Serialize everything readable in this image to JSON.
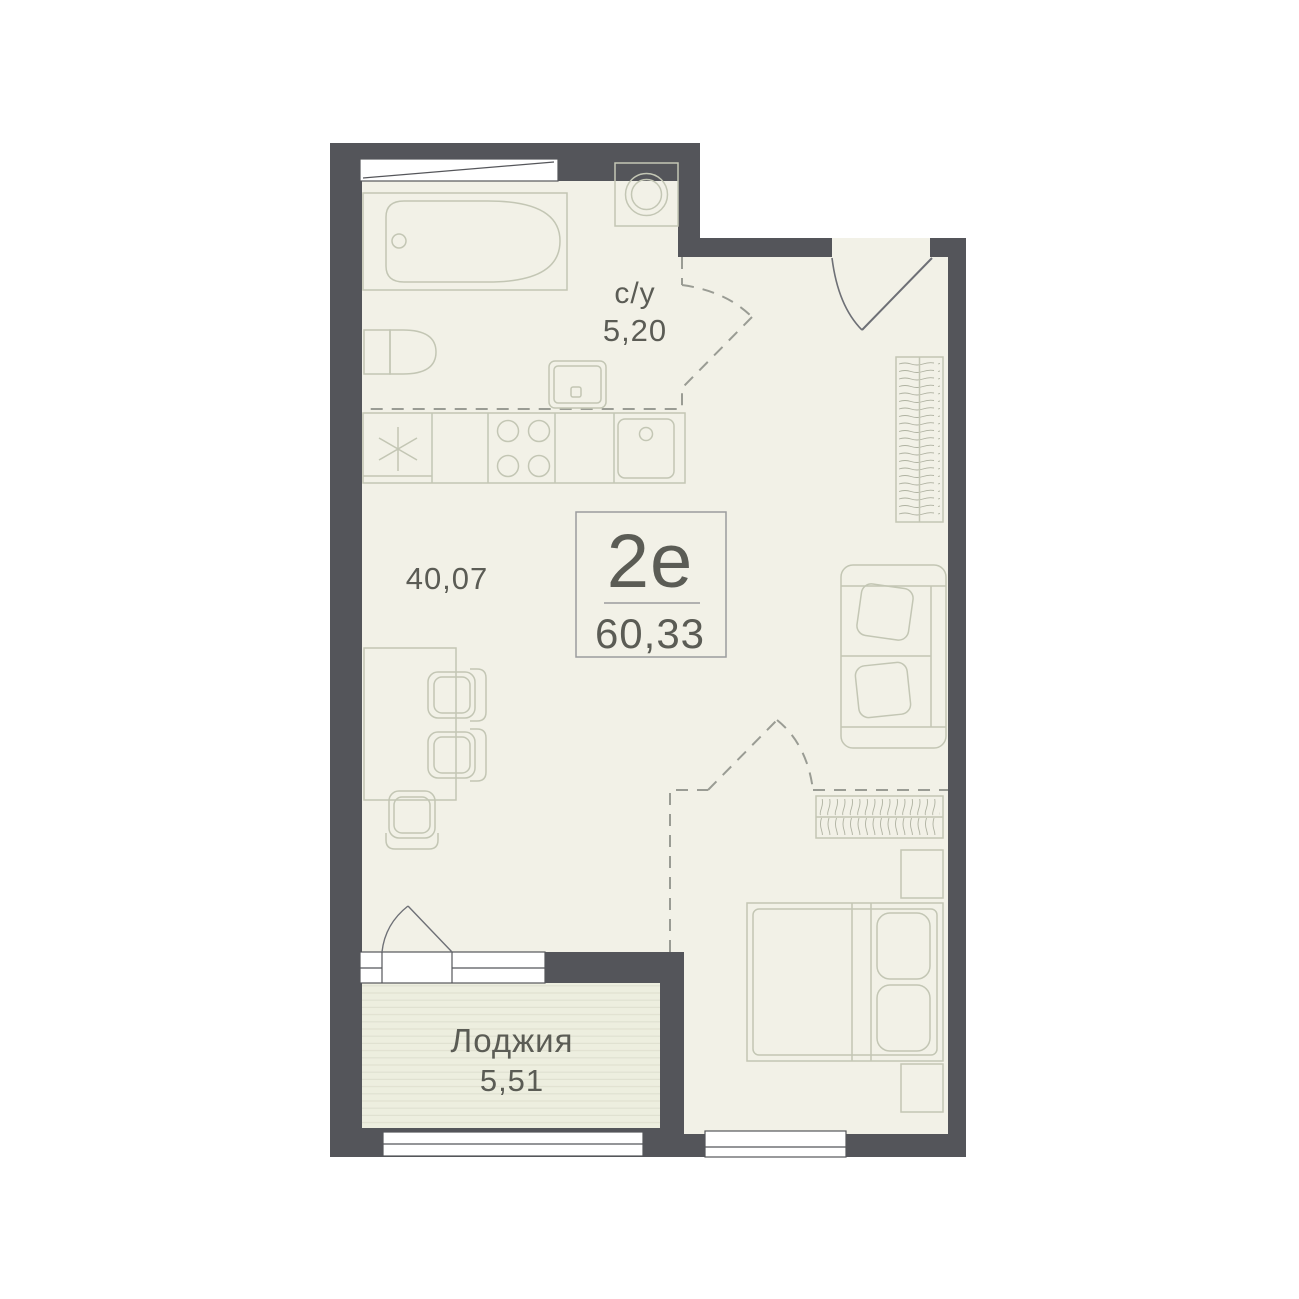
{
  "apartment": {
    "type_label": "2е",
    "total_area": "60,33"
  },
  "rooms": {
    "bathroom": {
      "label": "с/у",
      "area": "5,20"
    },
    "main": {
      "area": "40,07"
    },
    "loggia": {
      "label": "Лоджия",
      "area": "5,51"
    }
  },
  "colors": {
    "wall": "#54555A",
    "floor": "#F2F1E7",
    "loggiaFloor": "#EDEEDF",
    "stripe": "#E0E1D1",
    "furniture": "#C3C6B4",
    "squiggle": "#AEB1A0",
    "dashed": "#9A9C94",
    "door": "#6E7076",
    "frame": "#55565A",
    "text": "#5B5C55",
    "badgeBorder": "#9B9C9E",
    "windowWhite": "#FFFFFF"
  }
}
